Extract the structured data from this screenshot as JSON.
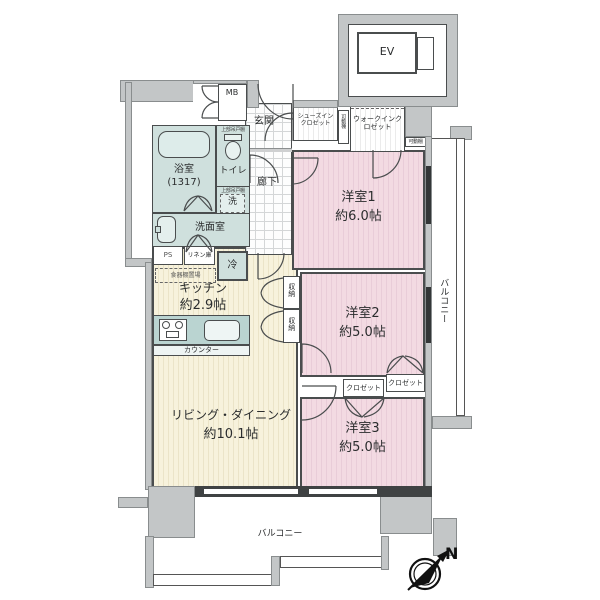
{
  "floor_plan": {
    "rooms": {
      "bedroom1": {
        "name": "洋室1",
        "size": "約6.0帖"
      },
      "bedroom2": {
        "name": "洋室2",
        "size": "約5.0帖"
      },
      "bedroom3": {
        "name": "洋室3",
        "size": "約5.0帖"
      },
      "living_dining": {
        "name": "リビング・ダイニング",
        "size": "約10.1帖"
      },
      "kitchen": {
        "name": "キッチン",
        "size": "約2.9帖"
      },
      "bathroom": {
        "name": "浴室",
        "size": "(1317)"
      },
      "toilet": {
        "name": "トイレ"
      },
      "washroom": {
        "name": "洗面室"
      },
      "entrance": {
        "name": "玄関"
      },
      "hallway": {
        "name": "廊下"
      },
      "shoes_in_closet": {
        "name": "シューズインクロゼット"
      },
      "walk_in_closet": {
        "name": "ウォークインクロゼット"
      }
    },
    "fixtures": {
      "elevator": "EV",
      "meter_box": "MB",
      "pipe_space": "PS",
      "linen_cabinet": "リネン庫",
      "refrigerator": "冷",
      "washer": "洗",
      "cupboard_space": "食器棚置場",
      "counter": "カウンター",
      "storage": "収納",
      "closet": "クロゼット",
      "movable_shelf": "可動棚",
      "upper_cabinet": "上部吊戸棚"
    },
    "balcony": {
      "label": "バルコニー"
    },
    "compass": {
      "north": "N"
    },
    "colors": {
      "bedroom_pink": "#f3dae2",
      "living_cream": "#f7f2dc",
      "wet_area_teal": "#cfe0dd",
      "wall_gray": "#c3c6c7"
    }
  }
}
